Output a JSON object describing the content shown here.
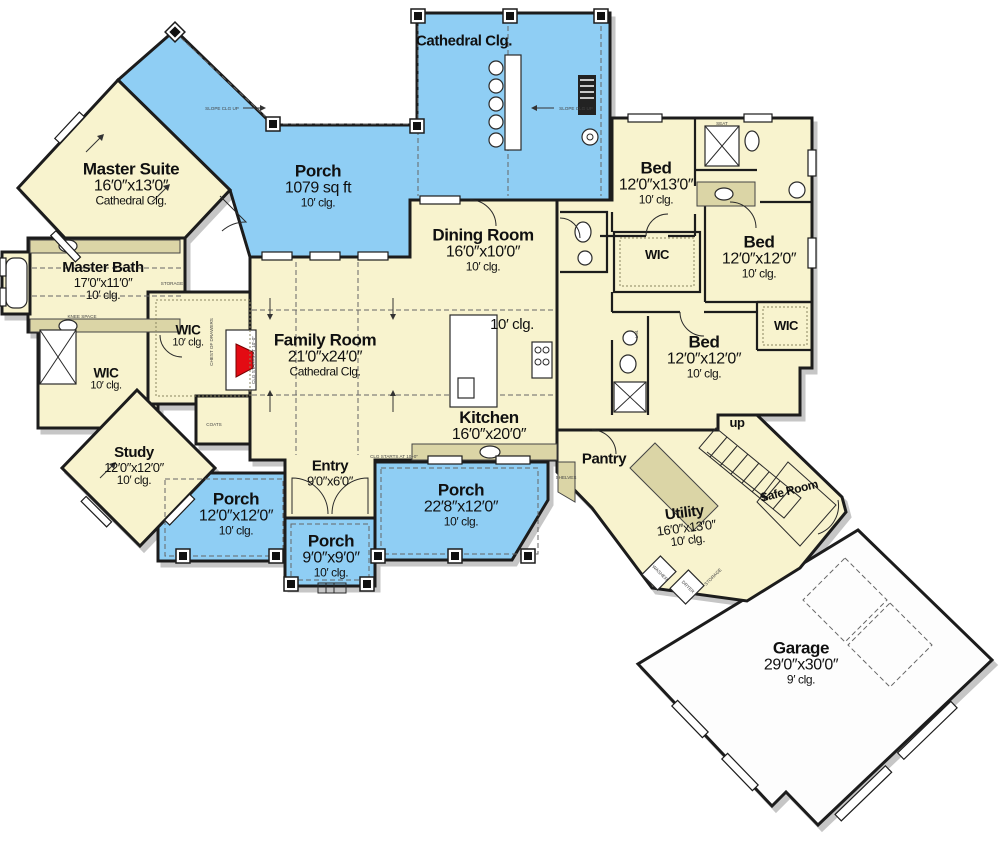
{
  "colors": {
    "porch": "#8FCEF4",
    "interior": "#F8F3CE",
    "garage": "#FDFDFD",
    "wall": "#1C1C1C",
    "fireplace": "#E30B13",
    "shade": "#DBD5A6",
    "shadow": "#C6C6C6"
  },
  "rooms": {
    "master_suite": {
      "name": "Master Suite",
      "dims": "16′0″x13′0″",
      "clg": "Cathedral Clg."
    },
    "porch_main": {
      "name": "Porch",
      "dims": "1079 sq ft",
      "clg": "10′ clg."
    },
    "porch_top": {
      "clg": "Cathedral Clg."
    },
    "master_bath": {
      "name": "Master Bath",
      "dims": "17′0″x11′0″",
      "clg": "10′ clg."
    },
    "bed_front": {
      "name": "Bed",
      "dims": "12′0″x13′0″",
      "clg": "10′ clg."
    },
    "bed_right": {
      "name": "Bed",
      "dims": "12′0″x12′0″",
      "clg": "10′ clg."
    },
    "bed_middle": {
      "name": "Bed",
      "dims": "12′0″x12′0″",
      "clg": "10′ clg."
    },
    "dining": {
      "name": "Dining Room",
      "dims": "16′0″x10′0″",
      "clg": "10′ clg."
    },
    "family": {
      "name": "Family Room",
      "dims": "21′0″x24′0″",
      "clg": "Cathedral Clg."
    },
    "kitchen": {
      "name": "Kitchen",
      "dims": "16′0″x20′0″"
    },
    "kitchen_clg": {
      "clg": "10′ clg."
    },
    "wic_master": {
      "name": "WIC",
      "clg": "10′ clg."
    },
    "wic_hall": {
      "name": "WIC",
      "clg": "10′ clg."
    },
    "wic_beds": {
      "name": "WIC"
    },
    "wic_right": {
      "name": "WIC"
    },
    "study": {
      "name": "Study",
      "dims": "12′0″x12′0″",
      "clg": "10′ clg."
    },
    "entry": {
      "name": "Entry",
      "dims": "9′0″x6′0″"
    },
    "pantry": {
      "name": "Pantry"
    },
    "up": {
      "name": "up"
    },
    "safe_room": {
      "name": "Safe Room"
    },
    "utility": {
      "name": "Utility",
      "dims": "16′0″x13′0″",
      "clg": "10′ clg."
    },
    "porch_left": {
      "name": "Porch",
      "dims": "12′0″x12′0″",
      "clg": "10′ clg."
    },
    "porch_center": {
      "name": "Porch",
      "dims": "9′0″x9′0″",
      "clg": "10′ clg."
    },
    "porch_right": {
      "name": "Porch",
      "dims": "22′8″x12′0″",
      "clg": "10′ clg."
    },
    "garage": {
      "name": "Garage",
      "dims": "29′0″x30′0″",
      "clg": "9′ clg."
    }
  },
  "fine_print": {
    "storage": "STORAGE",
    "knee_space": "KNEE SPACE",
    "chest": "CHEST OF DRAWERS",
    "coats": "COATS",
    "shelves": "SHELVES",
    "seat": "SEAT",
    "lin": "LIN.",
    "washer": "WASHER",
    "dryer": "DRYER",
    "slope": "SLOPE CLG UP",
    "clg_starts": "CLG STARTS AT 10′-0″"
  }
}
